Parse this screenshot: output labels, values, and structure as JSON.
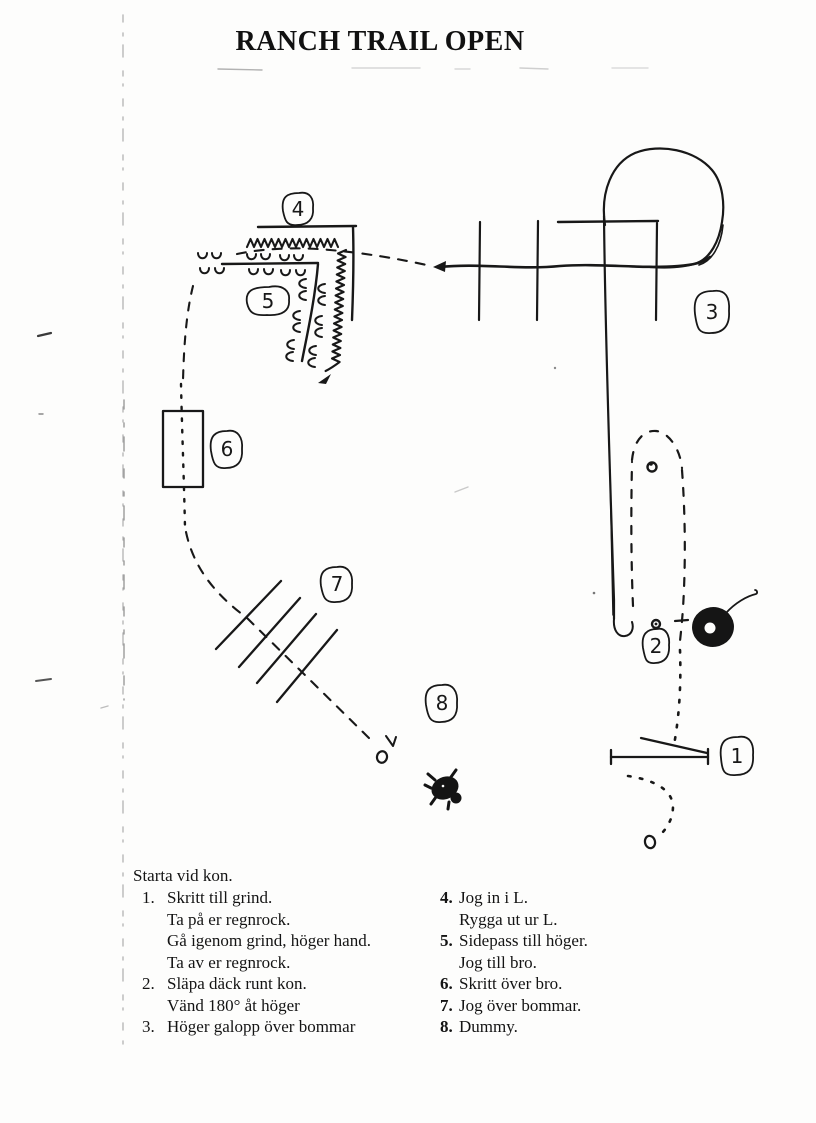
{
  "page_title": "RANCH TRAIL OPEN",
  "course_map": {
    "markers": [
      {
        "label": "1"
      },
      {
        "label": "2"
      },
      {
        "label": "3"
      },
      {
        "label": "4"
      },
      {
        "label": "5"
      },
      {
        "label": "6"
      },
      {
        "label": "7"
      },
      {
        "label": "8"
      }
    ]
  },
  "instructions": {
    "start_note": "Starta vid kon.",
    "left_column": [
      {
        "number": "1.",
        "lines": [
          "Skritt till grind.",
          "Ta på er regnrock.",
          "Gå igenom grind, höger hand.",
          "Ta av er regnrock."
        ]
      },
      {
        "number": "2.",
        "lines": [
          "Släpa däck runt kon.",
          "Vänd 180° åt höger"
        ]
      },
      {
        "number": "3.",
        "lines": [
          "Höger galopp över bommar"
        ]
      }
    ],
    "right_column": [
      {
        "number": "4.",
        "lines": [
          "Jog in i L.",
          "Rygga ut ur L."
        ]
      },
      {
        "number": "5.",
        "lines": [
          "Sidepass till höger.",
          "Jog till bro."
        ]
      },
      {
        "number": "6.",
        "lines": [
          "Skritt över bro."
        ]
      },
      {
        "number": "7.",
        "lines": [
          "Jog över bommar."
        ]
      },
      {
        "number": "8.",
        "lines": [
          "Dummy."
        ]
      }
    ]
  }
}
